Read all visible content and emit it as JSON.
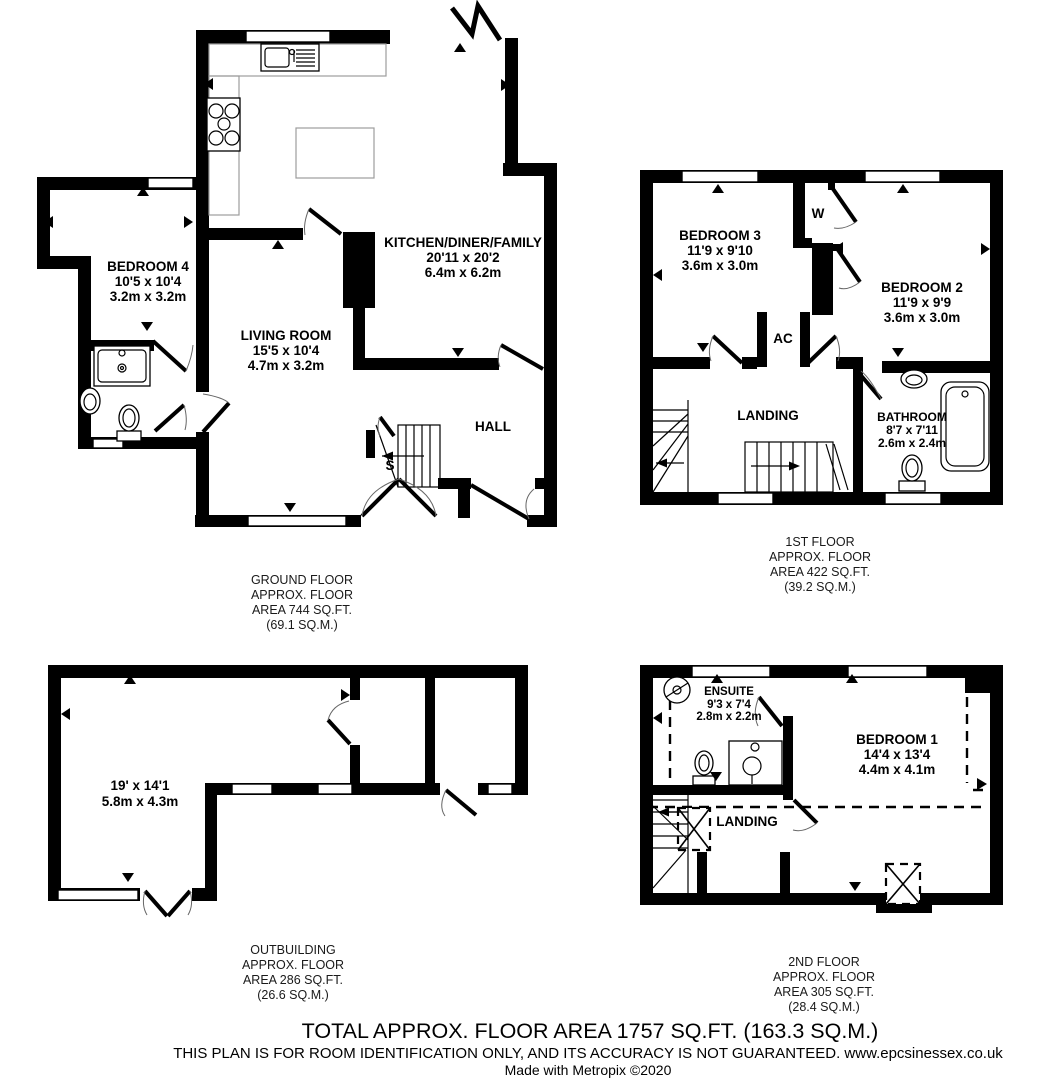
{
  "floors": {
    "ground": {
      "caption": [
        "GROUND FLOOR",
        "APPROX. FLOOR",
        "AREA 744 SQ.FT.",
        "(69.1 SQ.M.)"
      ],
      "rooms": {
        "kitchen": {
          "name": "KITCHEN/DINER/FAMILY",
          "imperial": "20'11 x 20'2",
          "metric": "6.4m x 6.2m"
        },
        "living": {
          "name": "LIVING ROOM",
          "imperial": "15'5 x 10'4",
          "metric": "4.7m x 3.2m"
        },
        "bedroom4": {
          "name": "BEDROOM 4",
          "imperial": "10'5 x 10'4",
          "metric": "3.2m x 3.2m"
        },
        "hall": {
          "name": "HALL"
        },
        "store": {
          "name": "S"
        }
      }
    },
    "first": {
      "caption": [
        "1ST FLOOR",
        "APPROX. FLOOR",
        "AREA 422 SQ.FT.",
        "(39.2 SQ.M.)"
      ],
      "rooms": {
        "bedroom3": {
          "name": "BEDROOM 3",
          "imperial": "11'9 x 9'10",
          "metric": "3.6m x 3.0m"
        },
        "bedroom2": {
          "name": "BEDROOM 2",
          "imperial": "11'9 x 9'9",
          "metric": "3.6m x 3.0m"
        },
        "bathroom": {
          "name": "BATHROOM",
          "imperial": "8'7 x 7'11",
          "metric": "2.6m x 2.4m"
        },
        "landing": {
          "name": "LANDING"
        },
        "wardrobe1": {
          "name": "W"
        },
        "wardrobe2": {
          "name": "W"
        },
        "airing": {
          "name": "AC"
        }
      }
    },
    "outbuilding": {
      "caption": [
        "OUTBUILDING",
        "APPROX. FLOOR",
        "AREA 286 SQ.FT.",
        "(26.6 SQ.M.)"
      ],
      "rooms": {
        "main": {
          "imperial": "19' x 14'1",
          "metric": "5.8m x 4.3m"
        }
      }
    },
    "second": {
      "caption": [
        "2ND FLOOR",
        "APPROX. FLOOR",
        "AREA 305 SQ.FT.",
        "(28.4 SQ.M.)"
      ],
      "rooms": {
        "bedroom1": {
          "name": "BEDROOM 1",
          "imperial": "14'4 x 13'4",
          "metric": "4.4m x 4.1m"
        },
        "ensuite": {
          "name": "ENSUITE",
          "imperial": "9'3 x 7'4",
          "metric": "2.8m x 2.2m"
        },
        "landing": {
          "name": "LANDING"
        }
      }
    }
  },
  "footer": {
    "line1": "TOTAL APPROX. FLOOR AREA 1757 SQ.FT. (163.3 SQ.M.)",
    "line2": "THIS PLAN IS FOR ROOM IDENTIFICATION ONLY, AND ITS ACCURACY IS NOT GUARANTEED. www.epcsinessex.co.uk",
    "line3": "Made with Metropix ©2020"
  }
}
